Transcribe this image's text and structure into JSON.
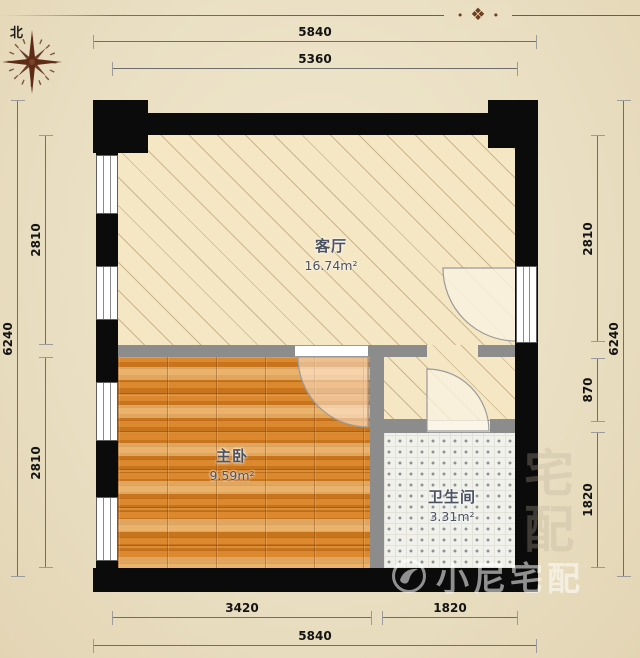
{
  "compass": {
    "label": "北"
  },
  "ornament": {
    "dot": "•",
    "glyph": "❖"
  },
  "rooms": {
    "living": {
      "name": "客厅",
      "area": "16.74m²"
    },
    "bedroom": {
      "name": "主卧",
      "area": "9.59m²"
    },
    "bathroom": {
      "name": "卫生间",
      "area": "3.31m²"
    }
  },
  "dimensions": {
    "top_outer": "5840",
    "top_inner": "5360",
    "bottom_bedroom": "3420",
    "bottom_bathroom": "1820",
    "bottom_outer": "5840",
    "left_outer": "6240",
    "left_upper": "2810",
    "left_lower": "2810",
    "right_upper": "2810",
    "right_middle": "870",
    "right_lower": "1820",
    "right_outer": "6240"
  },
  "watermark": {
    "text": "小尼宅配",
    "ghost": "宅配"
  },
  "colors": {
    "exterior_wall": "#0b0b0b",
    "interior_wall": "#8c8c8c",
    "living_floor": "#f5e7c4",
    "wood_floor": "#cd7a20",
    "tile_floor": "#f1f1ec",
    "parchment": "#eadfc3",
    "ornament_brown": "#6f3d1e"
  }
}
